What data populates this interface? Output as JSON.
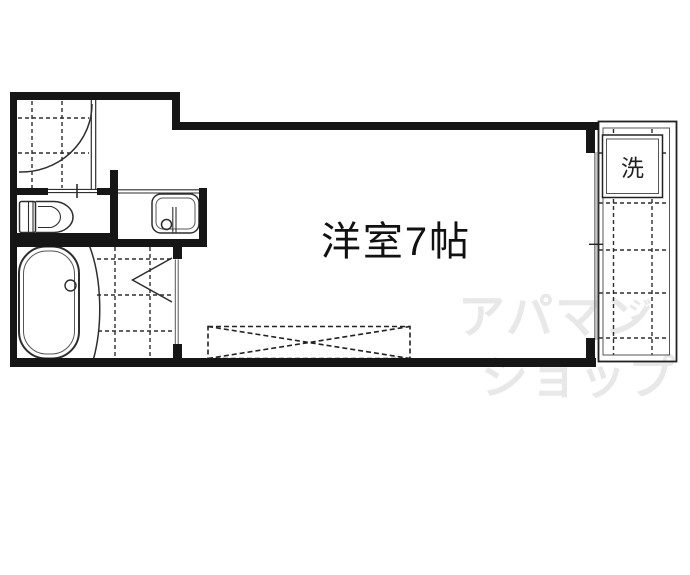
{
  "floorplan": {
    "room_label": "洋室7帖",
    "washer_label": "洗",
    "watermark": {
      "line1": "アパマン",
      "mark": "ジ",
      "line2": "ショップ",
      "color": "#e8e8e8"
    },
    "colors": {
      "background": "#ffffff",
      "wall": "#161616",
      "line": "#2e2e2e",
      "thin_line": "#555555",
      "window": "#8a8a8a",
      "text": "#111111"
    }
  }
}
